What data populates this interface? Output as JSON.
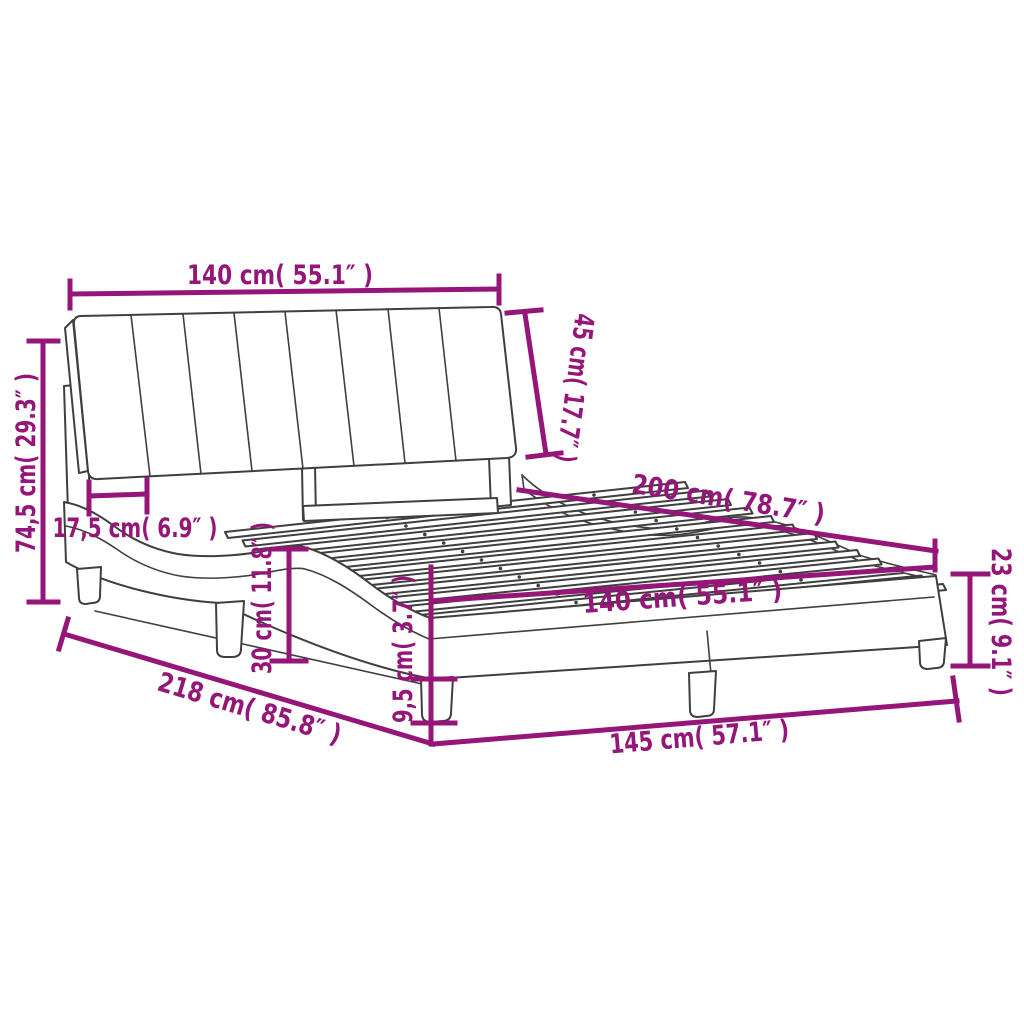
{
  "diagram_title": "bed-frame-dimension-diagram",
  "colors": {
    "dimension_accent": "#951579",
    "drawing_outline": "#3f3f3f",
    "background": "#ffffff"
  },
  "dimensions": [
    {
      "id": "headboard-width",
      "label": "140 cm( 55.1″ )"
    },
    {
      "id": "headboard-height",
      "label": "45 cm( 17.7″ )"
    },
    {
      "id": "overall-height",
      "label": "74,5 cm( 29.3″ )"
    },
    {
      "id": "headboard-leg-inset",
      "label": "17,5 cm( 6.9″ )"
    },
    {
      "id": "bed-length",
      "label": "200 cm( 78.7″ )"
    },
    {
      "id": "frame-side-height",
      "label": "23 cm( 9.1″ )"
    },
    {
      "id": "slat-base-width",
      "label": "140 cm( 55.1″ )"
    },
    {
      "id": "side-wave-height",
      "label": "30 cm( 11.8″ )"
    },
    {
      "id": "leg-height",
      "label": "9,5 cm( 3.7″ )"
    },
    {
      "id": "overall-length",
      "label": "218 cm( 85.8″ )"
    },
    {
      "id": "overall-width",
      "label": "145 cm( 57.1″ )"
    }
  ]
}
